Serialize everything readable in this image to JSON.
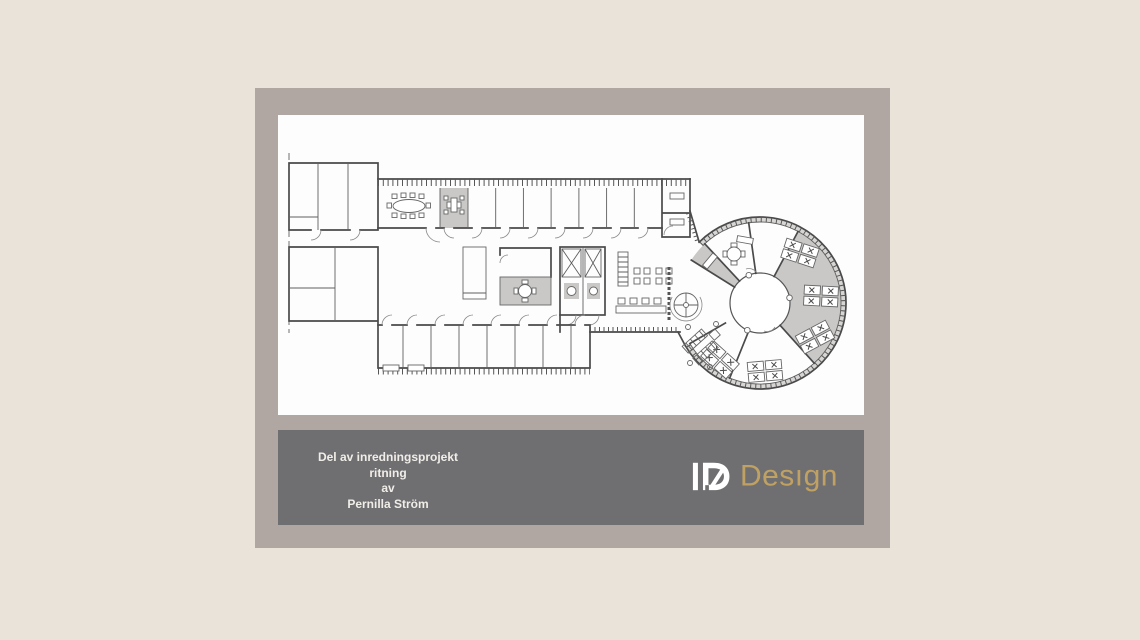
{
  "slide": {
    "caption": {
      "lines": [
        "Del av inredningsprojekt",
        "ritning",
        "av",
        "Pernilla Ström"
      ],
      "text_color": "#f1eee9"
    },
    "logo": {
      "mark": "ID",
      "text": "Desıgn",
      "mark_color": "#ffffff",
      "text_color": "#c0a164"
    },
    "colors": {
      "page_background": "#e9e3d9",
      "frame": "#b1a7a2",
      "panel": "#fdfdfd",
      "caption_bar": "#6f6e70"
    },
    "floorplan": {
      "content": "office floor plan: rectangular wing with cell offices, conference room, WC/kitchen core, and circular wing with radial desk clusters",
      "wall_color": "#4a4a4a",
      "shaded_zone_color": "#c9c8c6"
    }
  }
}
